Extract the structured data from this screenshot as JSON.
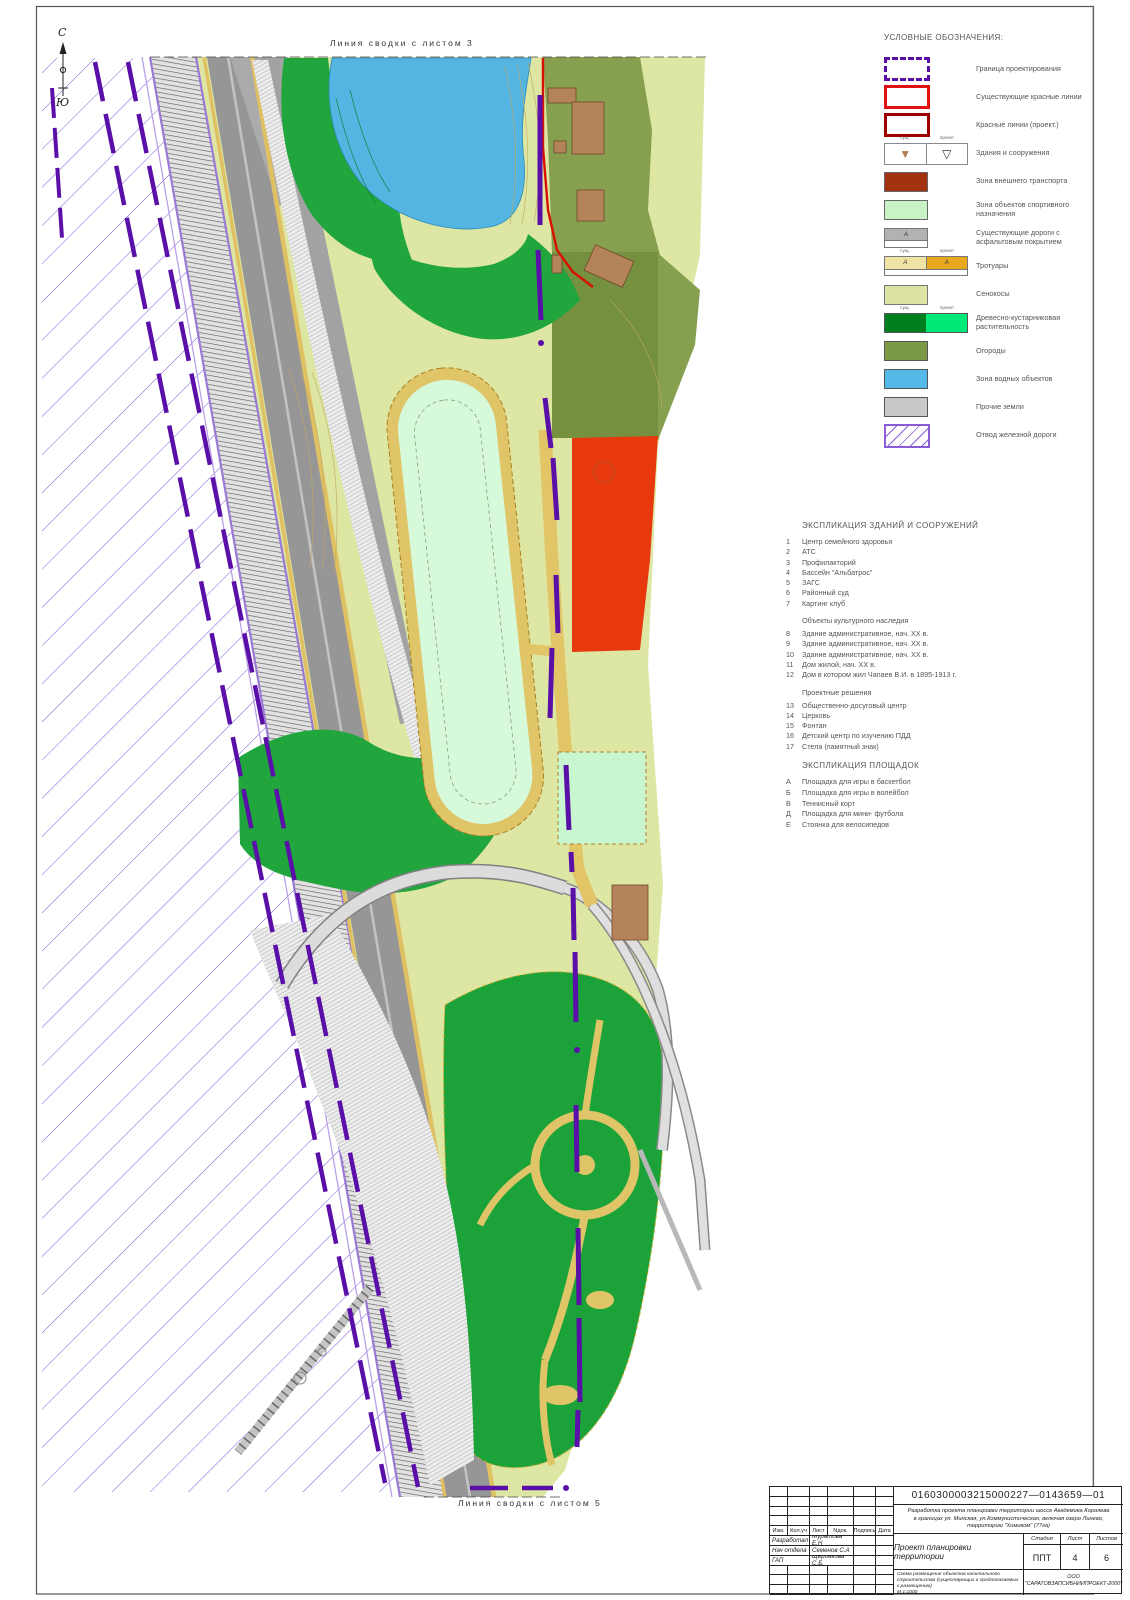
{
  "sheet": {
    "north": "С",
    "south": "Ю",
    "top_edge_label": "Линия сводки с листом 3",
    "bottom_edge_label": "Линия сводки с листом 5"
  },
  "colors": {
    "boundary_purple": "#5a0fa8",
    "red_lines_exist": "#e01010",
    "red_lines_proj": "#9c0000",
    "transport_zone": "#a33210",
    "sport_zone": "#c9f2c7",
    "hay": "#dce3a3",
    "trees_exist": "#007f20",
    "trees_proj": "#00e878",
    "gardens": "#7c9a45",
    "water": "#55b9e8",
    "other_lands": "#c9c9c9",
    "rail_purple": "#8a5cd6"
  },
  "legend": {
    "title": "УСЛОВНЫЕ ОБОЗНАЧЕНИЯ:",
    "headers": {
      "exist": "сущ.",
      "proj": "проект"
    },
    "road_letter": "А",
    "items": [
      {
        "label": "Граница проектирования",
        "swatch": "boundary"
      },
      {
        "label": "Существующие красные линии",
        "swatch": "redexist"
      },
      {
        "label": "Красные линии (проект.)",
        "swatch": "redproj"
      },
      {
        "label": "Здания и сооружения",
        "swatch": "bld",
        "headers": true
      },
      {
        "label": "Зона внешнего транспорта",
        "swatch": "transport"
      },
      {
        "label": "Зона объектов спортивного назначения",
        "swatch": "sport"
      },
      {
        "label": "Существующие дороги с асфальтовым покрытием",
        "swatch": "roads"
      },
      {
        "label": "Тротуары",
        "swatch": "walk",
        "headers": true
      },
      {
        "label": "Сенокосы",
        "swatch": "hay"
      },
      {
        "label": "Древесно-кустарниковая растительность",
        "swatch": "trees",
        "headers": true
      },
      {
        "label": "Огороды",
        "swatch": "gardens"
      },
      {
        "label": "Зона водных объектов",
        "swatch": "water"
      },
      {
        "label": "Прочие земли",
        "swatch": "other"
      },
      {
        "label": "Отвод железной дороги",
        "swatch": "rail"
      }
    ]
  },
  "explication_buildings": {
    "title": "ЭКСПЛИКАЦИЯ ЗДАНИЙ И СООРУЖЕНИЙ",
    "groups": [
      {
        "heading": "",
        "items": [
          {
            "num": "1",
            "label": "Центр семейного здоровья"
          },
          {
            "num": "2",
            "label": "АТС"
          },
          {
            "num": "3",
            "label": "Профилакторий"
          },
          {
            "num": "4",
            "label": "Бассейн \"Альбатрос\""
          },
          {
            "num": "5",
            "label": "ЗАГС"
          },
          {
            "num": "6",
            "label": "Районный суд"
          },
          {
            "num": "7",
            "label": "Картинг клуб"
          }
        ]
      },
      {
        "heading": "Объекты культурного наследия",
        "items": [
          {
            "num": "8",
            "label": "Здание административное, нач. XX в."
          },
          {
            "num": "9",
            "label": "Здание административное, нач. XX в."
          },
          {
            "num": "10",
            "label": "Здание административное, нач. XX в."
          },
          {
            "num": "11",
            "label": "Дом жилой, нач. XX в."
          },
          {
            "num": "12",
            "label": "Дом в котором жил Чапаев В.И. в 1895-1913 г."
          }
        ]
      },
      {
        "heading": "Проектные решения",
        "items": [
          {
            "num": "13",
            "label": "Общественно-досуговый центр"
          },
          {
            "num": "14",
            "label": "Церковь"
          },
          {
            "num": "15",
            "label": "Фонтан"
          },
          {
            "num": "16",
            "label": "Детский центр по изучению ПДД"
          },
          {
            "num": "17",
            "label": "Стела (памятный знак)"
          }
        ]
      }
    ]
  },
  "explication_areas": {
    "title": "ЭКСПЛИКАЦИЯ  ПЛОЩАДОК",
    "items": [
      {
        "num": "А",
        "label": "Площадка для игры в баскетбол"
      },
      {
        "num": "Б",
        "label": "Площадка для игры в волейбол"
      },
      {
        "num": "В",
        "label": "Теннисный корт"
      },
      {
        "num": "Д",
        "label": "Площадка для мини- футбола"
      },
      {
        "num": "Е",
        "label": "Стоянка для велосипедов"
      }
    ]
  },
  "map": {
    "labels": [
      {
        "t": "оз. Линево",
        "x": 398,
        "y": 142,
        "s": 8,
        "c": "#2080b8",
        "r": -63
      },
      {
        "t": "оз. Линево",
        "x": 370,
        "y": 94,
        "s": 6,
        "c": "#2080b8",
        "r": -63
      },
      {
        "t": "спорт.пл.",
        "x": 455,
        "y": 492,
        "s": 7,
        "c": "#556",
        "r": -82
      },
      {
        "t": "спорт.пл.",
        "x": 584,
        "y": 800,
        "s": 6.5,
        "c": "#556"
      },
      {
        "t": "А",
        "x": 597,
        "y": 812,
        "s": 7,
        "c": "#445"
      },
      {
        "t": "шоссе Академика Королева",
        "x": 208,
        "y": 208,
        "s": 7,
        "c": "#667",
        "r": -76
      },
      {
        "t": "шоссе Академика Королева",
        "x": 444,
        "y": 1335,
        "s": 7,
        "c": "#667",
        "r": -86
      },
      {
        "t": "Г",
        "x": 604,
        "y": 476,
        "s": 11,
        "c": "#b84a20",
        "a": "middle"
      },
      {
        "t": "У-47600",
        "x": 709,
        "y": 130,
        "s": 6,
        "c": "#333",
        "r": -90
      },
      {
        "t": "У-47600",
        "x": 721,
        "y": 108,
        "s": 6,
        "c": "#333",
        "r": -90
      },
      {
        "t": "Х 64100",
        "x": 726,
        "y": 101,
        "s": 6,
        "c": "#333"
      },
      {
        "t": "Х 94100",
        "x": 724,
        "y": 111,
        "s": 6,
        "c": "#333"
      },
      {
        "t": "КН",
        "x": 590,
        "y": 136,
        "s": 6,
        "c": "#444",
        "r": -90
      },
      {
        "t": "КН",
        "x": 593,
        "y": 214,
        "s": 6,
        "c": "#444",
        "r": -90
      },
      {
        "t": "КН",
        "x": 633,
        "y": 922,
        "s": 6,
        "c": "#444",
        "r": -90
      },
      {
        "t": "Н",
        "x": 560,
        "y": 99,
        "s": 5,
        "c": "#444"
      },
      {
        "t": "05.11.15",
        "x": 430,
        "y": 72,
        "s": 4.8,
        "c": "#444"
      }
    ],
    "elevations": [
      {
        "x": 432,
        "y": 64,
        "v": "21.22",
        "ul": true
      },
      {
        "x": 470,
        "y": 70,
        "v": "21.34"
      },
      {
        "x": 527,
        "y": 93,
        "v": "25.03"
      },
      {
        "x": 336,
        "y": 190,
        "v": "21.88",
        "ul": true
      },
      {
        "x": 238,
        "y": 190,
        "v": "27.44"
      },
      {
        "x": 506,
        "y": 188,
        "v": "22.34"
      },
      {
        "x": 468,
        "y": 163,
        "v": "21.48"
      },
      {
        "x": 258,
        "y": 232,
        "v": "27.65"
      },
      {
        "x": 452,
        "y": 233,
        "v": "21.43"
      },
      {
        "x": 324,
        "y": 240,
        "v": "25.81"
      },
      {
        "x": 268,
        "y": 318,
        "v": "27.56"
      },
      {
        "x": 500,
        "y": 313,
        "v": "28.58"
      },
      {
        "x": 577,
        "y": 64,
        "v": "28.47"
      },
      {
        "x": 553,
        "y": 88,
        "v": "27.59"
      },
      {
        "x": 581,
        "y": 102,
        "v": "28.73"
      },
      {
        "x": 557,
        "y": 120,
        "v": "27.21"
      },
      {
        "x": 580,
        "y": 155,
        "v": "28.17"
      },
      {
        "x": 558,
        "y": 163,
        "v": "27.22"
      },
      {
        "x": 593,
        "y": 183,
        "v": "28.12"
      },
      {
        "x": 573,
        "y": 192,
        "v": "28.14"
      },
      {
        "x": 583,
        "y": 220,
        "v": "28.04"
      },
      {
        "x": 600,
        "y": 250,
        "v": "27.88"
      },
      {
        "x": 575,
        "y": 276,
        "v": "27.24"
      },
      {
        "x": 610,
        "y": 277,
        "v": "21.64"
      },
      {
        "x": 510,
        "y": 353,
        "v": "26.96"
      },
      {
        "x": 580,
        "y": 392,
        "v": "27.31"
      },
      {
        "x": 452,
        "y": 418,
        "v": "27.40"
      },
      {
        "x": 548,
        "y": 485,
        "v": "27.42"
      },
      {
        "x": 492,
        "y": 560,
        "v": "27.35"
      },
      {
        "x": 556,
        "y": 580,
        "v": "27.46"
      },
      {
        "x": 592,
        "y": 604,
        "v": "27.13",
        "ul": true
      },
      {
        "x": 592,
        "y": 613,
        "v": "24.99"
      },
      {
        "x": 557,
        "y": 641,
        "v": "27.56"
      },
      {
        "x": 598,
        "y": 673,
        "v": "27.51",
        "ul": true
      },
      {
        "x": 598,
        "y": 682,
        "v": "24.51"
      },
      {
        "x": 544,
        "y": 687,
        "v": "28.27"
      },
      {
        "x": 535,
        "y": 734,
        "v": "28.11"
      },
      {
        "x": 597,
        "y": 735,
        "v": "25.22",
        "ul": true
      },
      {
        "x": 597,
        "y": 744,
        "v": "25.55"
      },
      {
        "x": 516,
        "y": 778,
        "v": "28.51"
      },
      {
        "x": 551,
        "y": 814,
        "v": "28.78"
      },
      {
        "x": 436,
        "y": 843,
        "v": "23.31"
      },
      {
        "x": 503,
        "y": 886,
        "v": "22.13"
      },
      {
        "x": 473,
        "y": 928,
        "v": "33.25"
      },
      {
        "x": 533,
        "y": 944,
        "v": "31.27"
      },
      {
        "x": 446,
        "y": 952,
        "v": "34.03"
      },
      {
        "x": 625,
        "y": 942,
        "v": "28.42"
      },
      {
        "x": 625,
        "y": 1110,
        "v": "28.37"
      },
      {
        "x": 543,
        "y": 1152,
        "v": "28.15"
      },
      {
        "x": 610,
        "y": 1142,
        "v": "27.58"
      },
      {
        "x": 622,
        "y": 1158,
        "v": "27.92"
      },
      {
        "x": 607,
        "y": 1188,
        "v": "27.35"
      },
      {
        "x": 429,
        "y": 1168,
        "v": "28.05"
      },
      {
        "x": 553,
        "y": 1232,
        "v": "27.95"
      },
      {
        "x": 448,
        "y": 1242,
        "v": "40.64"
      },
      {
        "x": 613,
        "y": 1320,
        "v": "28.58"
      },
      {
        "x": 615,
        "y": 1375,
        "v": "28.33"
      },
      {
        "x": 597,
        "y": 1420,
        "v": "28.87"
      },
      {
        "x": 255,
        "y": 450,
        "v": "28.77"
      },
      {
        "x": 325,
        "y": 487,
        "v": "26.93"
      },
      {
        "x": 337,
        "y": 520,
        "v": "25.23"
      },
      {
        "x": 330,
        "y": 552,
        "v": "25.85"
      }
    ],
    "crosses": [
      [
        348,
        98
      ],
      [
        713,
        85
      ],
      [
        713,
        280
      ],
      [
        713,
        470
      ],
      [
        713,
        655
      ],
      [
        713,
        845
      ],
      [
        713,
        1030
      ],
      [
        713,
        1215
      ],
      [
        713,
        1400
      ],
      [
        150,
        655
      ],
      [
        347,
        1052
      ],
      [
        534,
        668
      ],
      [
        537,
        1242
      ]
    ]
  },
  "title_block": {
    "doc_number": "0160300003215000227—0143659—01",
    "description_lines": [
      "Разработка проекта планировки территории шоссе Академика Королева",
      "в границах ул. Минская, ул.Коммунистическая, включая озеро Линево,",
      "территорию \"Химиком\" (77га)"
    ],
    "head": [
      "Изм.",
      "Кол.уч",
      "Лист",
      "Nдок.",
      "Подпись",
      "Дата"
    ],
    "signers": [
      {
        "role": "Разработал",
        "name": "Муратова Е.Н"
      },
      {
        "role": "Нач отдела",
        "name": "Семенов С.А"
      },
      {
        "role": "ГАП",
        "name": "Щербакова С.Б."
      }
    ],
    "project_title": "Проект планировки территории",
    "stage_label": "Стадия",
    "sheet_label": "Лист",
    "sheets_label": "Листов",
    "stage": "ППТ",
    "sheet_num": "4",
    "sheets_total": "6",
    "scheme_note": "Схема размещения объектов капитального строительства (существующих и предполагаемых к размещению)",
    "scale": "М 1:1000",
    "company_line1": "ООО",
    "company_line2": "\"САРАТОВЗАПСИБНИИПРОЕКТ-2000\""
  }
}
